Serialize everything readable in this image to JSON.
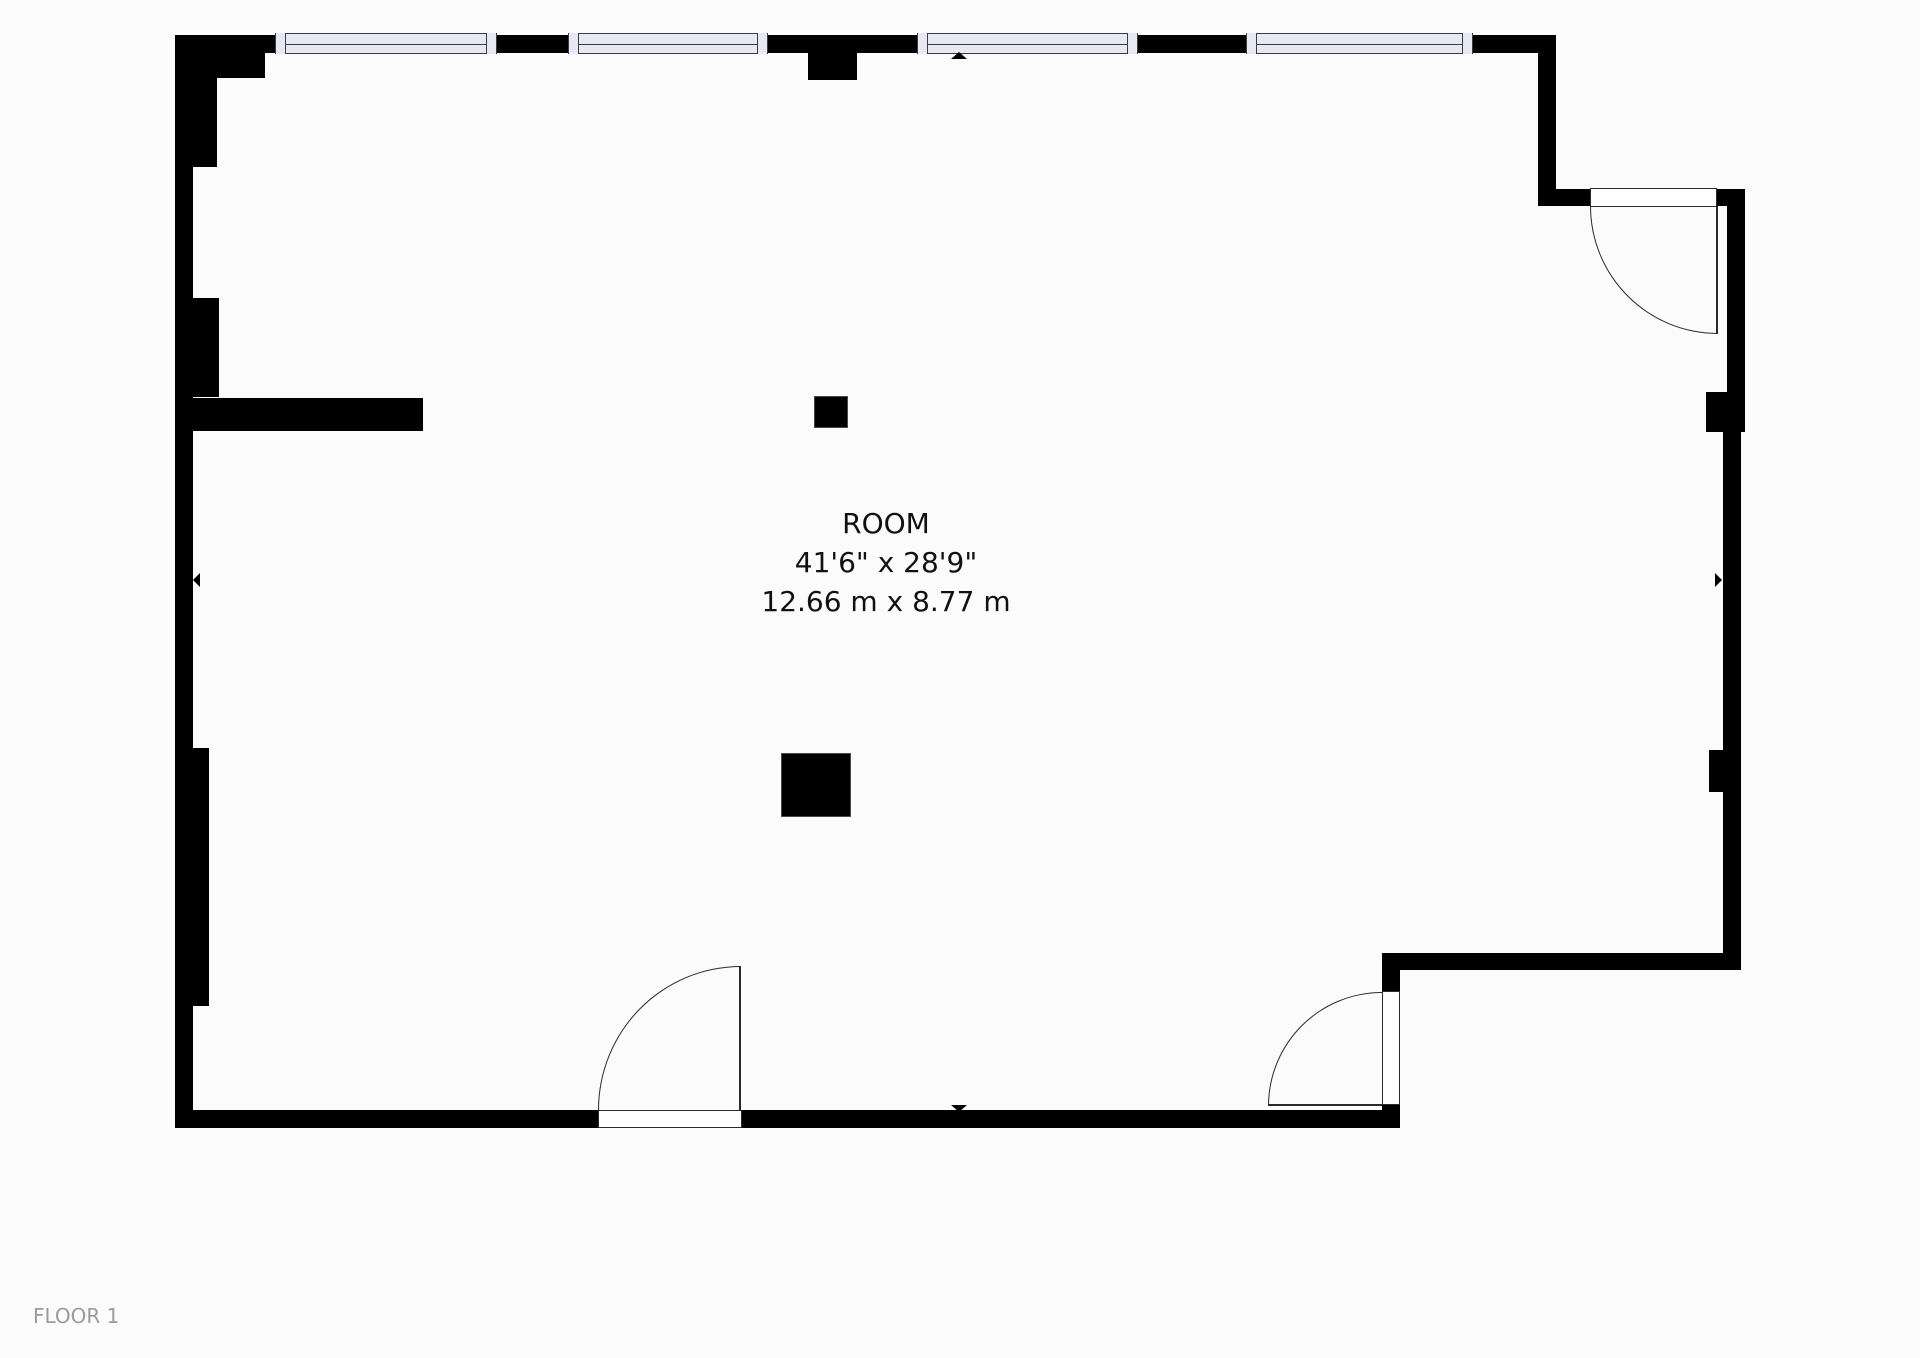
{
  "floor": {
    "label": "FLOOR 1"
  },
  "room": {
    "name": "ROOM",
    "size_imperial": "41'6\" x 28'9\"",
    "size_metric": "12.66 m x 8.77 m"
  },
  "colors": {
    "background": "#fbfbfb",
    "wall": "#000000",
    "window-fill": "#e8e8f4",
    "window-border": "#3b3b44",
    "door-line": "#2a2a2a",
    "label": "#111111",
    "floor-label": "#9b9b9b"
  },
  "markers": {
    "top": "dimension-marker-up",
    "bottom": "dimension-marker-down",
    "left": "dimension-marker-left",
    "right": "dimension-marker-right"
  }
}
